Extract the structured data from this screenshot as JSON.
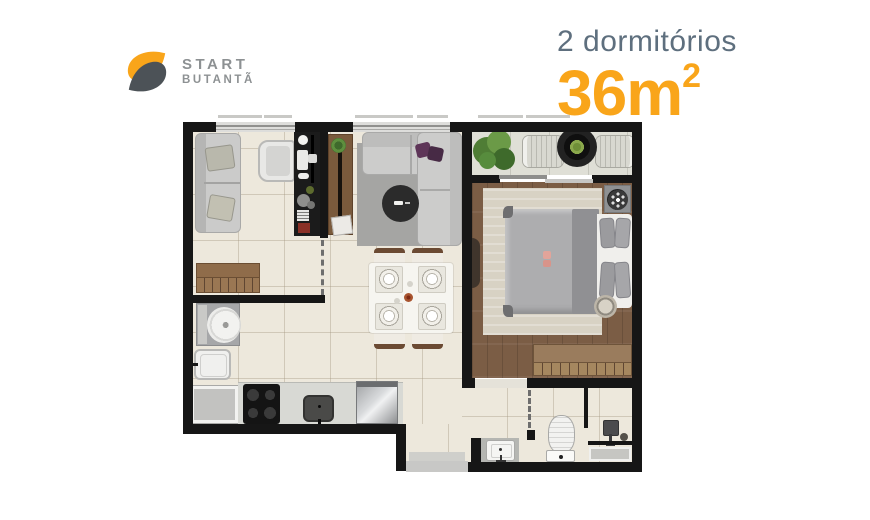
{
  "header": {
    "logo": {
      "line1": "START",
      "line2": "BUTANTÃ"
    },
    "unit_type": "2 dormitórios",
    "area_value": "36m",
    "area_sup": "2"
  },
  "colors": {
    "accent_orange": "#f9a51a",
    "logo_dark": "#4c5257",
    "logo_gray_text": "#8d9193",
    "title_slate": "#5e6f7e",
    "wall_black": "#161616",
    "floor_beige": "#ede8dc",
    "wood_brown": "#7b5d45"
  },
  "floorplan": {
    "rooms": [
      {
        "name": "bedroom-2-office",
        "furniture": [
          "sofa-bed",
          "lounge-chair",
          "tv-work-panel",
          "wardrobe-rack"
        ]
      },
      {
        "name": "living-room",
        "furniture": [
          "corner-sofa",
          "round-coffee-table",
          "wood-console",
          "rug"
        ]
      },
      {
        "name": "dining-area",
        "furniture": [
          "table-for-4",
          "4-chairs",
          "place-settings"
        ]
      },
      {
        "name": "kitchen",
        "furniture": [
          "counter",
          "cooktop-stove",
          "sink",
          "refrigerator"
        ]
      },
      {
        "name": "laundry",
        "furniture": [
          "washing-machine",
          "laundry-tub",
          "cabinet"
        ]
      },
      {
        "name": "balcony",
        "furniture": [
          "fern-plant",
          "two-lounge-chairs",
          "round-black-table"
        ]
      },
      {
        "name": "master-bedroom",
        "furniture": [
          "double-bed",
          "headboard-pillows",
          "rug",
          "dresser-rack",
          "side-table",
          "round-stool"
        ]
      },
      {
        "name": "bathroom",
        "furniture": [
          "vanity-sink",
          "toilet",
          "shower-head",
          "shower-mat"
        ]
      }
    ]
  }
}
